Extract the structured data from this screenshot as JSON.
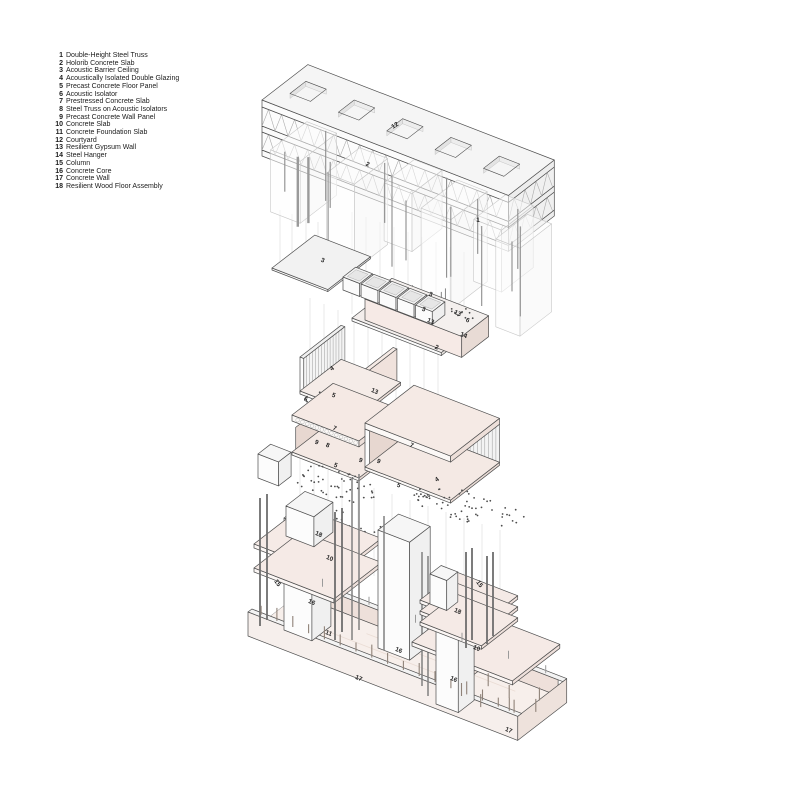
{
  "legend": {
    "items": [
      {
        "n": "1",
        "label": "Double-Height Steel Truss"
      },
      {
        "n": "2",
        "label": "Holorib Concrete Slab"
      },
      {
        "n": "3",
        "label": "Acoustic Barrier Ceiling"
      },
      {
        "n": "4",
        "label": "Acoustically Isolated Double Glazing"
      },
      {
        "n": "5",
        "label": "Precast Concrete Floor Panel"
      },
      {
        "n": "6",
        "label": "Acoustic Isolator"
      },
      {
        "n": "7",
        "label": "Prestressed Concrete Slab"
      },
      {
        "n": "8",
        "label": "Steel Truss on Acoustic Isolators"
      },
      {
        "n": "9",
        "label": "Precast Concrete Wall Panel"
      },
      {
        "n": "10",
        "label": "Concrete Slab"
      },
      {
        "n": "11",
        "label": "Concrete Foundation Slab"
      },
      {
        "n": "12",
        "label": "Courtyard"
      },
      {
        "n": "13",
        "label": "Resilient Gypsum Wall"
      },
      {
        "n": "14",
        "label": "Steel Hanger"
      },
      {
        "n": "15",
        "label": "Column"
      },
      {
        "n": "16",
        "label": "Concrete Core"
      },
      {
        "n": "17",
        "label": "Concrete Wall"
      },
      {
        "n": "18",
        "label": "Resilient Wood Floor Assembly"
      }
    ]
  },
  "diagram": {
    "callouts": [
      {
        "n": "12",
        "x": 396,
        "y": 127,
        "r": -33
      },
      {
        "n": "2",
        "x": 367,
        "y": 166,
        "r": 22
      },
      {
        "n": "1",
        "x": 478,
        "y": 222,
        "r": 0
      },
      {
        "n": "3",
        "x": 322,
        "y": 262,
        "r": 22
      },
      {
        "n": "3",
        "x": 430,
        "y": 296,
        "r": 22
      },
      {
        "n": "13",
        "x": 457,
        "y": 315,
        "r": 22
      },
      {
        "n": "3",
        "x": 423,
        "y": 311,
        "r": 22
      },
      {
        "n": "13",
        "x": 430,
        "y": 323,
        "r": 22
      },
      {
        "n": "6",
        "x": 467,
        "y": 322,
        "r": 22
      },
      {
        "n": "14",
        "x": 463,
        "y": 337,
        "r": 22
      },
      {
        "n": "2",
        "x": 436,
        "y": 349,
        "r": 22
      },
      {
        "n": "4",
        "x": 333,
        "y": 370,
        "r": -33
      },
      {
        "n": "13",
        "x": 374,
        "y": 393,
        "r": 22
      },
      {
        "n": "5",
        "x": 333,
        "y": 397,
        "r": 22
      },
      {
        "n": "6",
        "x": 305,
        "y": 401,
        "r": 22
      },
      {
        "n": "7",
        "x": 334,
        "y": 430,
        "r": 22
      },
      {
        "n": "9",
        "x": 316,
        "y": 444,
        "r": 22
      },
      {
        "n": "8",
        "x": 327,
        "y": 447,
        "r": 22
      },
      {
        "n": "5",
        "x": 335,
        "y": 467,
        "r": 22
      },
      {
        "n": "9",
        "x": 360,
        "y": 462,
        "r": 22
      },
      {
        "n": "7",
        "x": 411,
        "y": 447,
        "r": 22
      },
      {
        "n": "9",
        "x": 378,
        "y": 463,
        "r": 22
      },
      {
        "n": "5",
        "x": 398,
        "y": 487,
        "r": 22
      },
      {
        "n": "4",
        "x": 438,
        "y": 481,
        "r": -33
      },
      {
        "n": "18",
        "x": 318,
        "y": 536,
        "r": 22
      },
      {
        "n": "10",
        "x": 329,
        "y": 560,
        "r": 22
      },
      {
        "n": "15",
        "x": 276,
        "y": 584,
        "r": 55
      },
      {
        "n": "16",
        "x": 311,
        "y": 604,
        "r": 22
      },
      {
        "n": "11",
        "x": 328,
        "y": 635,
        "r": 22
      },
      {
        "n": "17",
        "x": 358,
        "y": 680,
        "r": 22
      },
      {
        "n": "16",
        "x": 398,
        "y": 652,
        "r": 22
      },
      {
        "n": "16",
        "x": 453,
        "y": 681,
        "r": 22
      },
      {
        "n": "15",
        "x": 478,
        "y": 585,
        "r": 55
      },
      {
        "n": "18",
        "x": 457,
        "y": 613,
        "r": 22
      },
      {
        "n": "10",
        "x": 476,
        "y": 650,
        "r": 22
      },
      {
        "n": "17",
        "x": 508,
        "y": 732,
        "r": 22
      }
    ]
  },
  "colors": {
    "outline": "#4f4f4f",
    "lightOutline": "#c8c8c8",
    "stripe": "#9a9a9a",
    "dot": "#4d4d4d",
    "projLine": "#e3e3e3",
    "hanger": "#8d8d8d",
    "whiteFace": "#fbfbfb",
    "grayTop": "#f4f4f4",
    "graySide": "#ededed",
    "pinkTop": "#f5eae5",
    "pinkFront": "#f0e2dc",
    "pinkDeep": "#e7d7d0",
    "labelColor": "#232323"
  }
}
